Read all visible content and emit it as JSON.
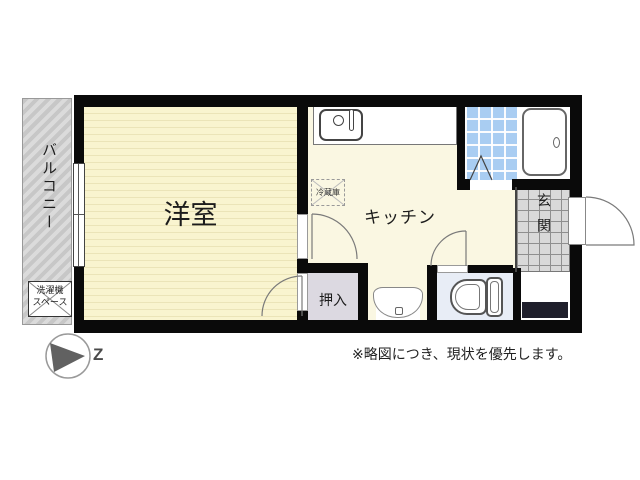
{
  "floorplan": {
    "balcony": {
      "label": "バルコニー"
    },
    "washer_space": {
      "line1": "洗濯機",
      "line2": "スペース"
    },
    "western_room": {
      "label": "洋室"
    },
    "kitchen": {
      "label": "キッチン"
    },
    "fridge": {
      "label": "冷蔵庫"
    },
    "closet": {
      "label": "押入"
    },
    "entrance": {
      "label": "玄関"
    },
    "compass": {
      "label": "Z"
    },
    "note": "※略図につき、現状を優先します。",
    "colors": {
      "wall": "#0a0a0a",
      "western_room_floor": "#f9f4cf",
      "kitchen_floor": "#faf7e2",
      "bath_tile": "#a9cdf2",
      "entrance_tile": "#d9d9d9",
      "closet_floor": "#dcd9e1",
      "toilet_floor": "#e8edf6",
      "balcony": "#c7c7c7",
      "entrance_step": "#1f1f2b",
      "compass_arrow": "#616161"
    }
  }
}
